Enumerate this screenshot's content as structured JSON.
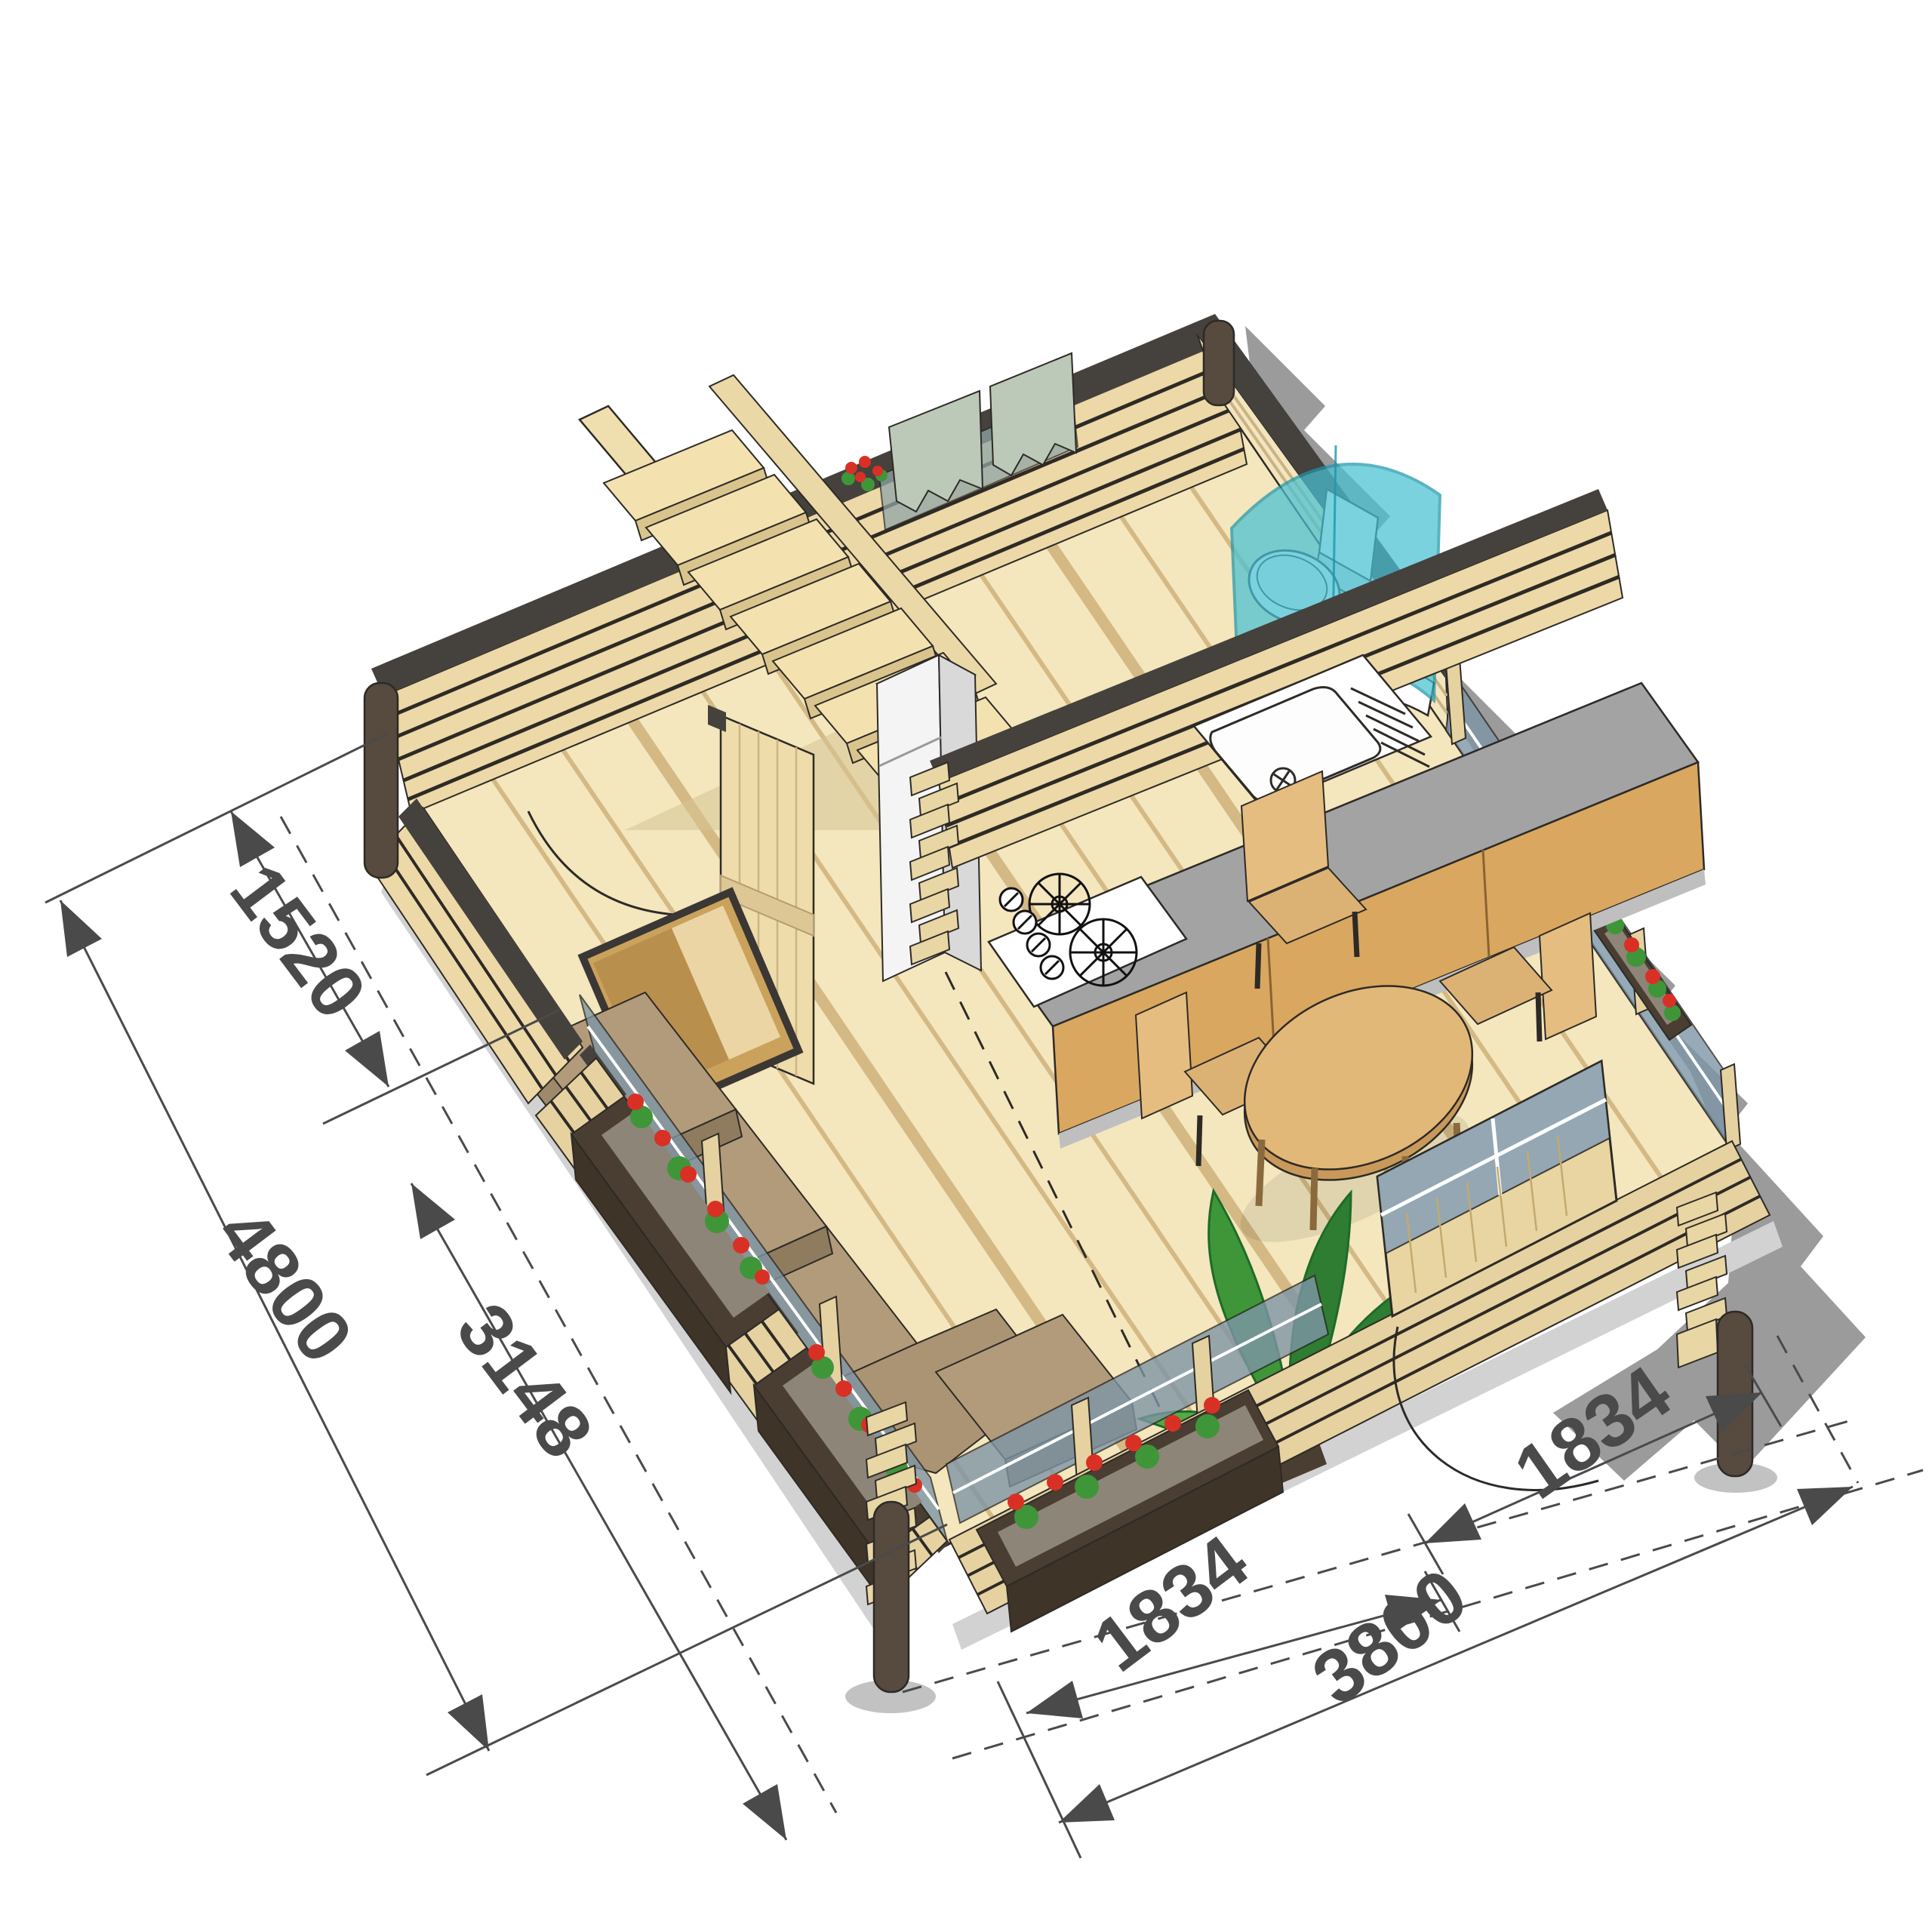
{
  "drawing": {
    "type": "isometric-cutaway-floor-plan",
    "dimension_labels": {
      "left_wall_section": "1520",
      "left_total": "4800",
      "left_interior": "3148",
      "front_door_section": "1834",
      "front_total": "3800",
      "right_section": "1834"
    },
    "colors": {
      "background": "#ffffff",
      "shadow": "#9b9b9b",
      "ground_shadow": "#cfcfcf",
      "wall_wood": "#ecd9a7",
      "wall_line": "#2d2a26",
      "trim_dark": "#45413d",
      "post_brown": "#574a3e",
      "floor": "#f4e6bd",
      "floor_stripe": "#cfb27b",
      "counter_gray": "#a3a3a3",
      "cabinet_wood": "#d9a75f",
      "furniture_wood": "#e2b878",
      "sofa_cushion": "#b29b7a",
      "sofa_cushion_dark": "#8f7c5e",
      "glass": "#7e95a6",
      "shower_glass": "#49c2d4",
      "curtain_green": "#bcc9b8",
      "flower_red": "#d93025",
      "leaf_green": "#3f9638",
      "planter_brown": "#4a3e33",
      "dimension": "#4a4a4a",
      "white": "#ffffff"
    }
  }
}
